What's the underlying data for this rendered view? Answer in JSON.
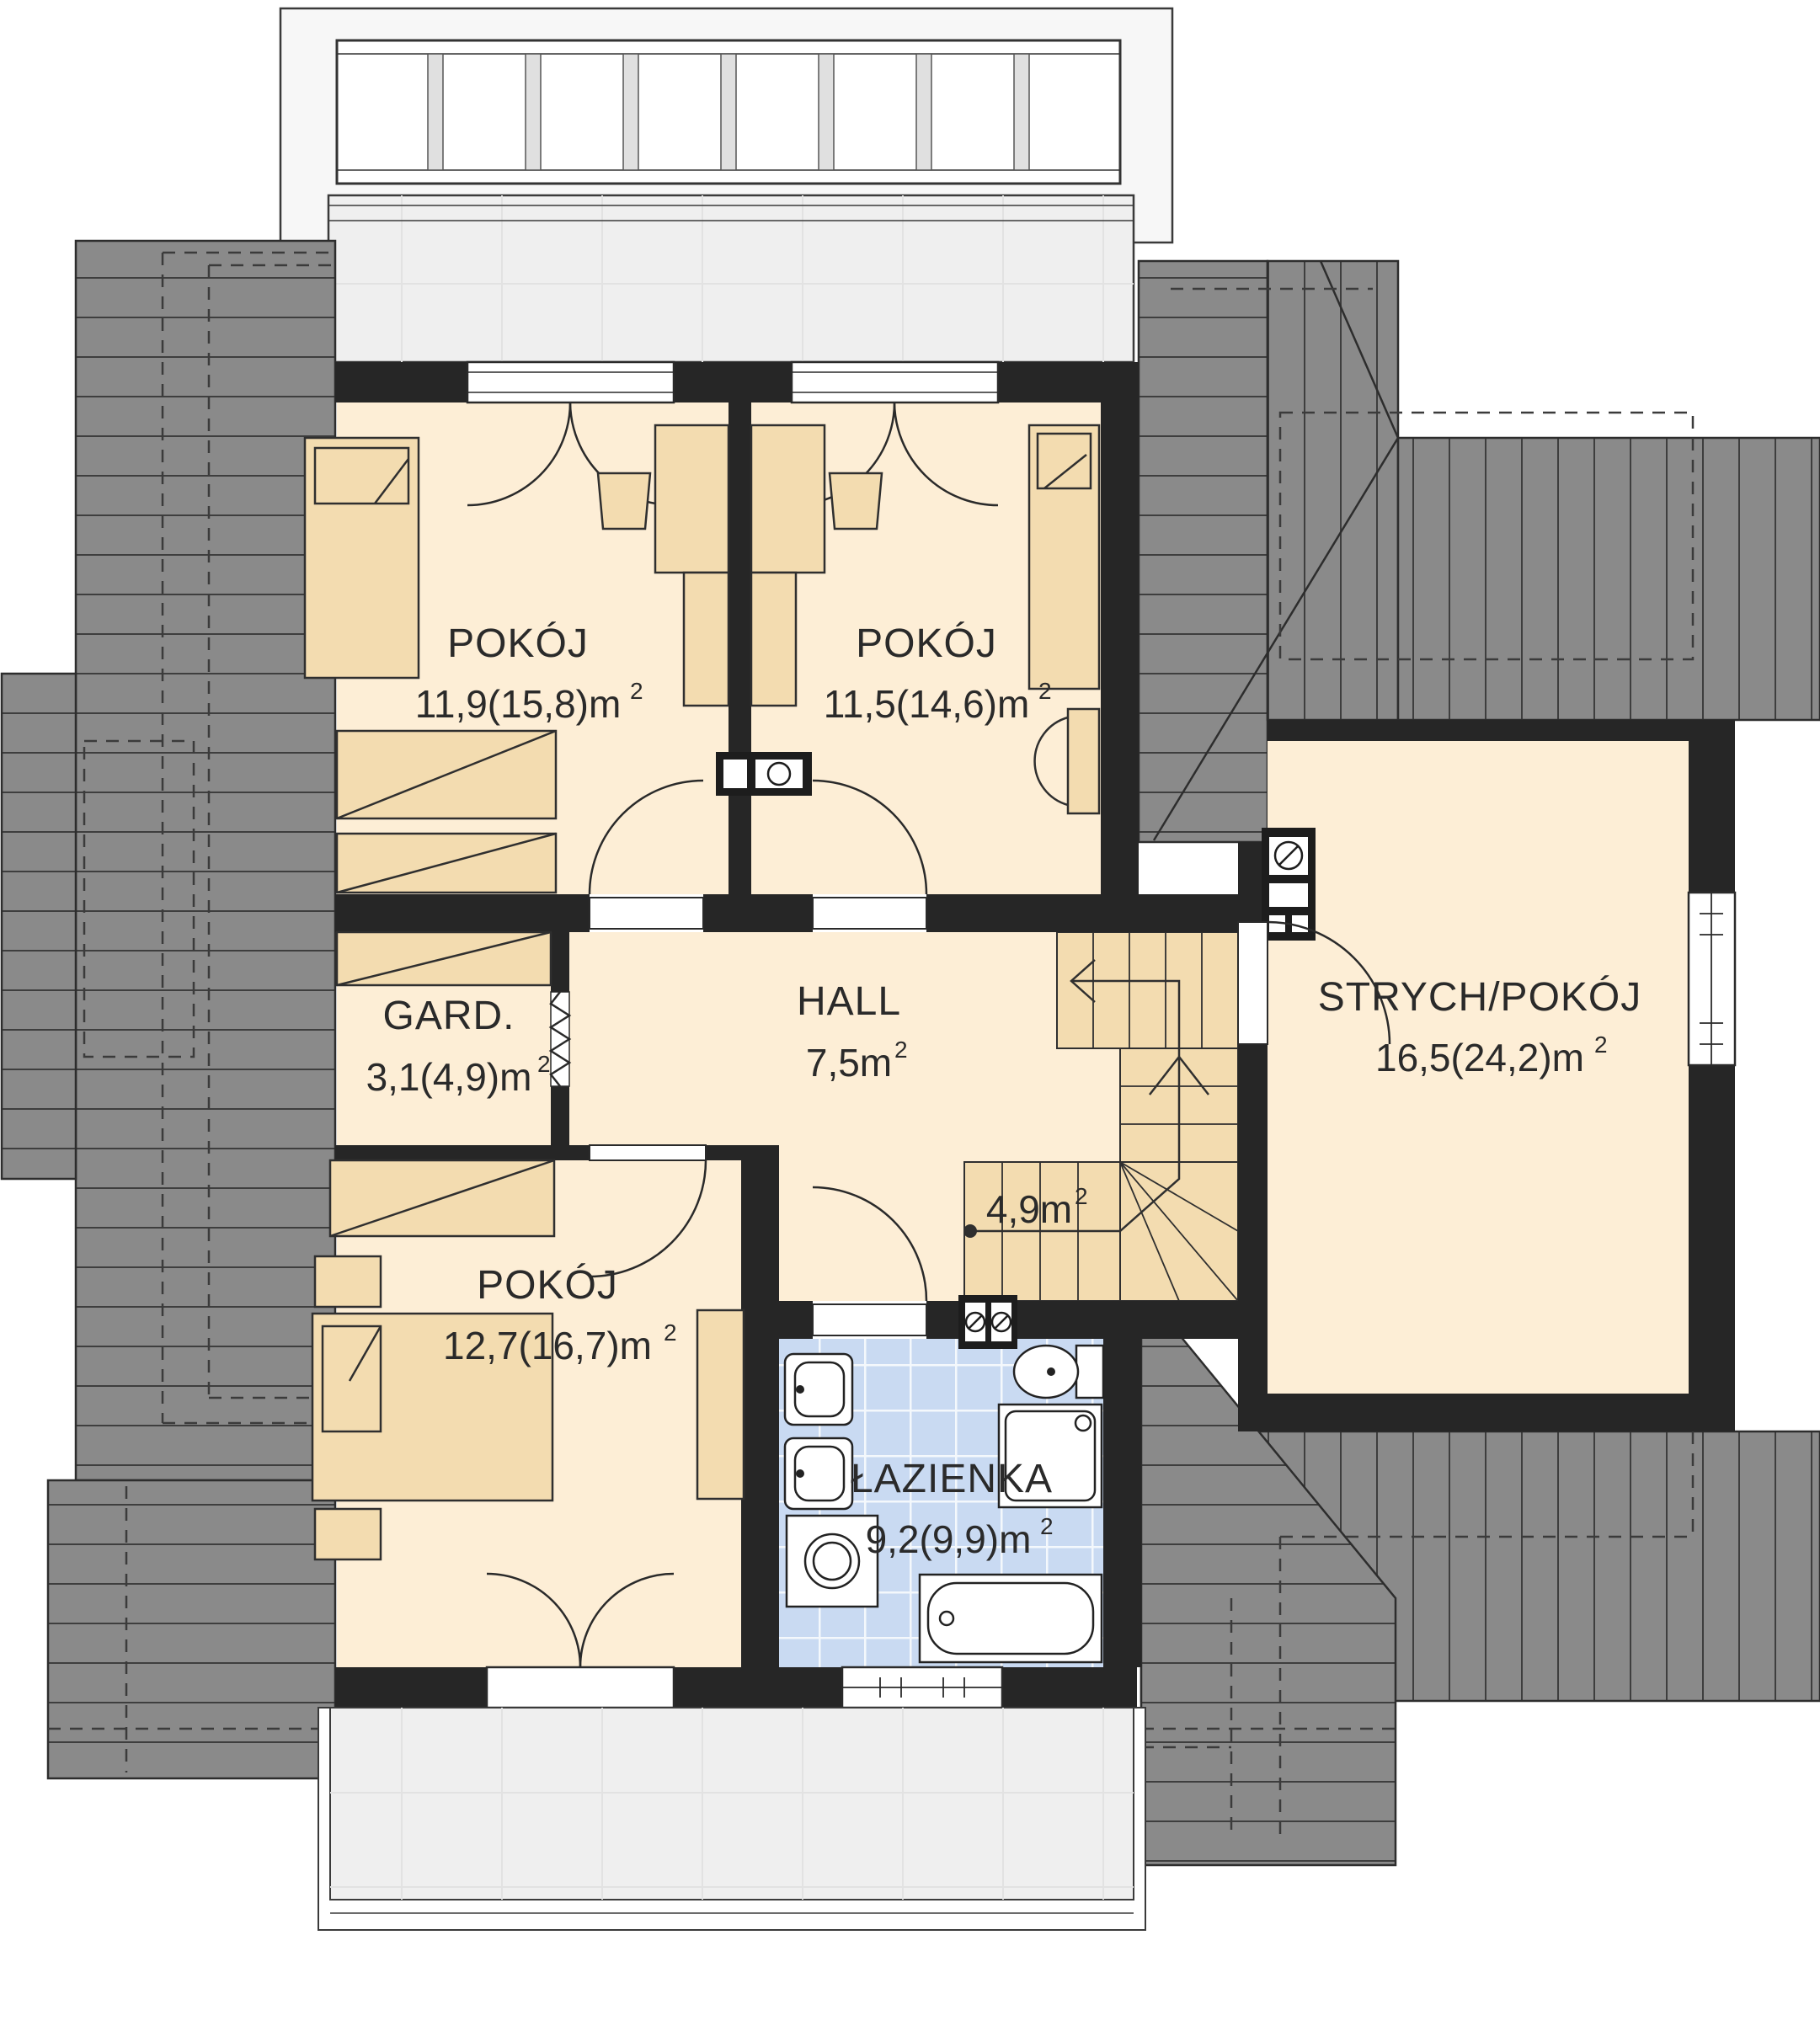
{
  "plan_type": "floor-plan",
  "rooms": {
    "pokoj1": {
      "label": "POKÓJ",
      "area": "11,9(15,8)m",
      "sup": "2"
    },
    "pokoj2": {
      "label": "POKÓJ",
      "area": "11,5(14,6)m",
      "sup": "2"
    },
    "gard": {
      "label": "GARD.",
      "area": "3,1(4,9)m",
      "sup": "2"
    },
    "hall": {
      "label": "HALL",
      "area": "7,5m",
      "sup": "2"
    },
    "stairwell": {
      "area": "4,9m",
      "sup": "2"
    },
    "strych": {
      "label": "STRYCH/POKÓJ",
      "area": "16,5(24,2)m",
      "sup": "2"
    },
    "pokoj3": {
      "label": "POKÓJ",
      "area": "12,7(16,7)m",
      "sup": "2"
    },
    "lazienka": {
      "label": "ŁAZIENKA",
      "area": "9,2(9,9)m",
      "sup": "2"
    }
  },
  "fixtures": [
    "bed",
    "desk",
    "chair",
    "wardrobe",
    "double-bed",
    "nightstand",
    "shelf",
    "washbasin",
    "toilet",
    "shower",
    "bathtub",
    "washing-machine",
    "stairs",
    "chimney-flue",
    "balcony-railing",
    "folding-door"
  ],
  "colors": {
    "roof": "#8a8a8a",
    "roof_line": "#3e3e3e",
    "wall": "#262626",
    "room_fill": "#fdeed6",
    "furniture_fill": "#f3dcb0",
    "bathroom_tile": "#c9daf2",
    "balcony_floor": "#efefef",
    "outline": "#2d2d2d"
  }
}
